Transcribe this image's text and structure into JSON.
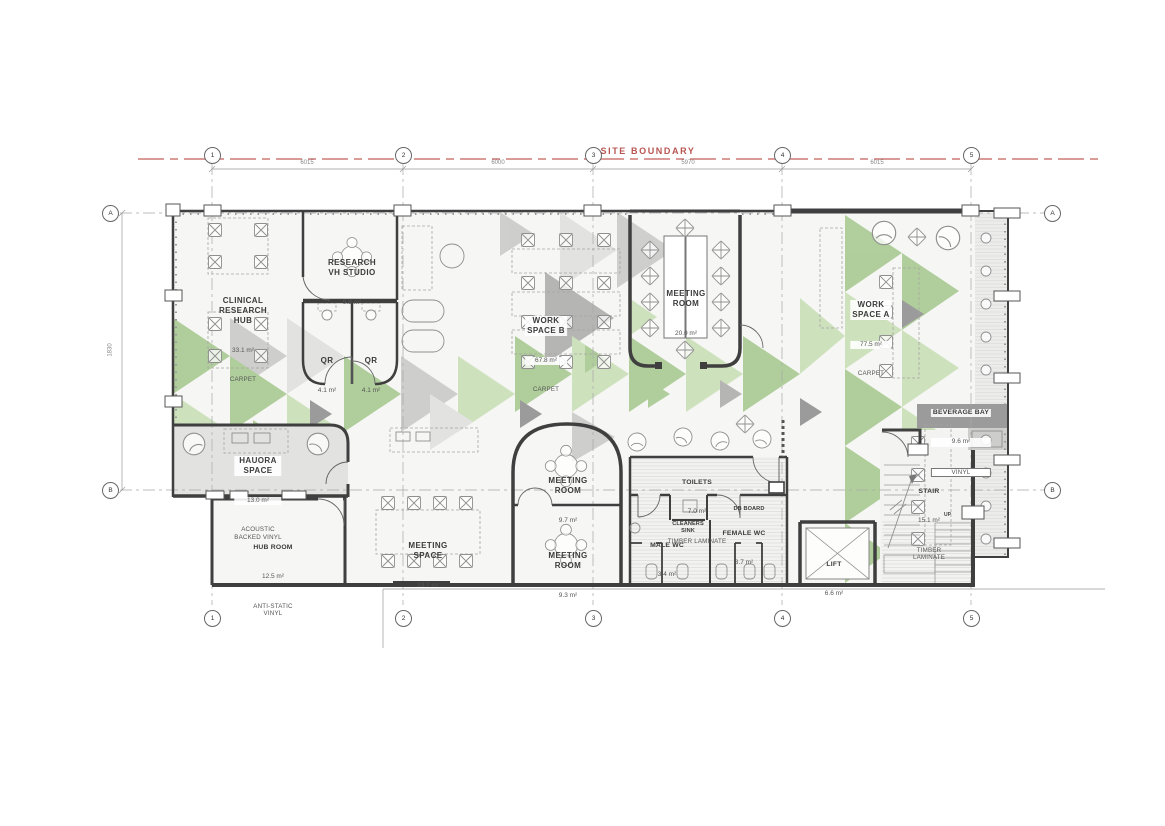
{
  "plan": {
    "site_boundary_label": "SITE BOUNDARY",
    "grid": {
      "cols": [
        "1",
        "2",
        "3",
        "4",
        "5"
      ],
      "rows": [
        "A",
        "B"
      ],
      "top_dims": [
        "6015",
        "6000",
        "5970",
        "6015"
      ],
      "left_dim": "1830"
    },
    "rooms": {
      "clinical_research_hub": {
        "name": "CLINICAL\nRESEARCH\nHUB",
        "area": "33.1 m²",
        "finish": "CARPET"
      },
      "research_vh_studio": {
        "name": "RESEARCH\nVH STUDIO",
        "area": "9.8 m²"
      },
      "qr_1": {
        "name": "QR",
        "area": "4.1 m²"
      },
      "qr_2": {
        "name": "QR",
        "area": "4.1 m²"
      },
      "work_space_b": {
        "name": "WORK\nSPACE B",
        "area": "67.8 m²",
        "finish": "CARPET"
      },
      "meeting_room_large": {
        "name": "MEETING\nROOM",
        "area": "20.0 m²"
      },
      "work_space_a": {
        "name": "WORK\nSPACE A",
        "area": "77.5 m²",
        "finish": "CARPET"
      },
      "hauora_space": {
        "name": "HAUORA\nSPACE",
        "area": "13.0 m²",
        "finish": "ACOUSTIC\nBACKED VINYL"
      },
      "hub_room": {
        "name": "HUB ROOM",
        "area": "12.5 m²",
        "finish": "ANTI-STATIC\nVINYL"
      },
      "meeting_space": {
        "name": "MEETING\nSPACE",
        "area": "33.7 m²"
      },
      "meeting_room_97": {
        "name": "MEETING\nROOM",
        "area": "9.7 m²"
      },
      "meeting_room_93": {
        "name": "MEETING\nROOM",
        "area": "9.3 m²"
      },
      "toilets": {
        "name": "TOILETS",
        "area": "7.0 m²",
        "finish": "TIMBER LAMINATE"
      },
      "db_board": {
        "name": "DB BOARD"
      },
      "cleaners_sink": {
        "name": "CLEANERS\nSINK"
      },
      "male_wc": {
        "name": "MALE WC",
        "area": "3.4 m²"
      },
      "female_wc": {
        "name": "FEMALE WC",
        "area": "3.7 m²"
      },
      "lift": {
        "name": "LIFT",
        "area": "6.6 m²"
      },
      "stair": {
        "name": "STAIR",
        "area": "15.1 m²",
        "finish": "TIMBER\nLAMINATE",
        "direction": "UP"
      },
      "beverage_bay": {
        "name": "BEVERAGE BAY",
        "area": "9.6 m²",
        "finish": "VINYL"
      }
    },
    "colors": {
      "site_boundary": "#c0564f",
      "wall": "#3f3f3f",
      "pattern_green": "#a7c98f",
      "pattern_green_light": "#c9dfb6",
      "pattern_gray": "#adadab",
      "pattern_gray_light": "#c9c9c7",
      "counter_gray": "#9b9b9b"
    }
  }
}
